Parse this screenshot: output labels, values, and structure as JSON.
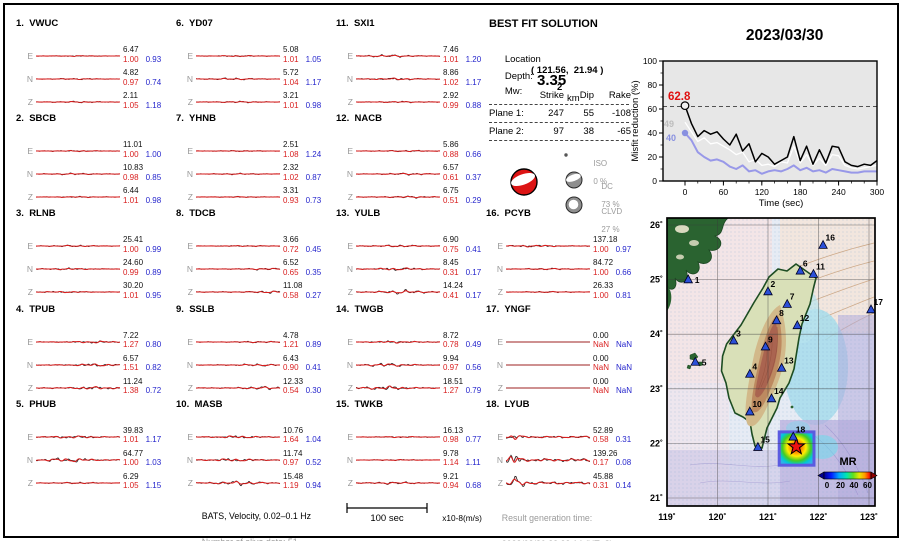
{
  "header": {
    "date": "2023/03/30",
    "time": "15:20:20  (UT)"
  },
  "solution": {
    "title": "BEST FIT SOLUTION",
    "location_label": "Location",
    "location_value": "( 121.56,  21.94 )",
    "depth_label": "Depth:",
    "depth_value": "2",
    "depth_unit": "km",
    "mw_label": "Mw:",
    "mw_value": "3.35",
    "table": {
      "headers": [
        "Strike",
        "Dip",
        "Rake"
      ],
      "rows": [
        {
          "label": "Plane 1:",
          "strike": "247",
          "dip": "55",
          "rake": "-108"
        },
        {
          "label": "Plane 2:",
          "strike": "97",
          "dip": "38",
          "rake": "-65"
        }
      ]
    },
    "decomposition": [
      {
        "name": "ISO",
        "percent": "0 %"
      },
      {
        "name": "DC",
        "percent": "73 %"
      },
      {
        "name": "CLVD",
        "percent": "27 %"
      }
    ]
  },
  "misfit_plot": {
    "ylabel": "Misfit reduction (%)",
    "xlabel": "Time (sec)",
    "peak_label": "62.8",
    "start_labels": {
      "white": "49",
      "blue": "40"
    },
    "yticks": [
      0,
      20,
      40,
      60,
      80,
      100
    ],
    "xticks": [
      0,
      60,
      120,
      180,
      240,
      300
    ]
  },
  "chart_data": {
    "type": "line",
    "title": "Misfit reduction vs time",
    "xlabel": "Time (sec)",
    "ylabel": "Misfit reduction (%)",
    "xlim": [
      0,
      300
    ],
    "ylim": [
      0,
      100
    ],
    "threshold_dashed_y": 62,
    "x": [
      0,
      10,
      20,
      30,
      40,
      50,
      60,
      70,
      80,
      90,
      100,
      110,
      120,
      130,
      140,
      150,
      160,
      170,
      180,
      190,
      200,
      210,
      220,
      230,
      240,
      250,
      260,
      270,
      280,
      290,
      300
    ],
    "series": [
      {
        "name": "best solution (black)",
        "color": "#000000",
        "y": [
          62.8,
          48,
          37,
          42,
          39,
          41,
          35,
          30,
          39,
          25,
          31,
          16,
          23,
          20,
          14,
          17,
          20,
          37,
          17,
          29,
          14,
          26,
          15,
          29,
          28,
          16,
          13,
          12,
          14,
          13,
          17
        ]
      },
      {
        "name": "reference solution (white)",
        "color": "#ffffff",
        "y": [
          49,
          41,
          33,
          36,
          31,
          32,
          29,
          26,
          22,
          24,
          16,
          18,
          13,
          14,
          12,
          16,
          15,
          29,
          15,
          22,
          13,
          19,
          13,
          22,
          21,
          13,
          11,
          10,
          11,
          12,
          13
        ]
      },
      {
        "name": "reference solution (blue)",
        "color": "#9898e8",
        "y": [
          40,
          34,
          24,
          20,
          17,
          18,
          16,
          12,
          10,
          13,
          8,
          9,
          6,
          8,
          9,
          8,
          10,
          13,
          9,
          11,
          8,
          9,
          7,
          10,
          9,
          8,
          7,
          7,
          8,
          8,
          8
        ]
      }
    ]
  },
  "stations": [
    {
      "num": "1",
      "name": "VWUC",
      "traces": [
        {
          "comp": "E",
          "amp": "6.47",
          "m1": "1.00",
          "m2": "0.93",
          "w": 0.7,
          "p": 0.5
        },
        {
          "comp": "N",
          "amp": "4.82",
          "m1": "0.97",
          "m2": "0.74",
          "w": 0.8,
          "p": 0.5
        },
        {
          "comp": "Z",
          "amp": "2.11",
          "m1": "1.05",
          "m2": "1.18",
          "w": 0.9,
          "p": 0.5
        }
      ]
    },
    {
      "num": "2",
      "name": "SBCB",
      "traces": [
        {
          "comp": "E",
          "amp": "11.01",
          "m1": "1.00",
          "m2": "1.00",
          "w": 0.9,
          "p": 0.5
        },
        {
          "comp": "N",
          "amp": "10.83",
          "m1": "0.98",
          "m2": "0.85",
          "w": 1.0,
          "p": 0.45
        },
        {
          "comp": "Z",
          "amp": "6.44",
          "m1": "1.01",
          "m2": "0.98",
          "w": 0.8,
          "p": 0.5
        }
      ]
    },
    {
      "num": "3",
      "name": "RLNB",
      "traces": [
        {
          "comp": "E",
          "amp": "25.41",
          "m1": "1.00",
          "m2": "0.99",
          "w": 1.1,
          "p": 0.45
        },
        {
          "comp": "N",
          "amp": "24.60",
          "m1": "0.99",
          "m2": "0.89",
          "w": 1.3,
          "p": 0.4
        },
        {
          "comp": "Z",
          "amp": "30.20",
          "m1": "1.01",
          "m2": "0.95",
          "w": 1.2,
          "p": 0.35
        }
      ]
    },
    {
      "num": "4",
      "name": "TPUB",
      "traces": [
        {
          "comp": "E",
          "amp": "7.22",
          "m1": "1.27",
          "m2": "0.80",
          "w": 1.8,
          "p": 0.68
        },
        {
          "comp": "N",
          "amp": "6.57",
          "m1": "1.51",
          "m2": "0.82",
          "w": 2.2,
          "p": 0.7
        },
        {
          "comp": "Z",
          "amp": "11.24",
          "m1": "1.38",
          "m2": "0.72",
          "w": 2.6,
          "p": 0.7
        }
      ]
    },
    {
      "num": "5",
      "name": "PHUB",
      "traces": [
        {
          "comp": "E",
          "amp": "39.83",
          "m1": "1.01",
          "m2": "1.17",
          "w": 2.4,
          "p": 0.45
        },
        {
          "comp": "N",
          "amp": "64.77",
          "m1": "1.00",
          "m2": "1.03",
          "w": 3.4,
          "p": 0.4
        },
        {
          "comp": "Z",
          "amp": "6.29",
          "m1": "1.05",
          "m2": "1.15",
          "w": 1.0,
          "p": 0.5
        }
      ]
    },
    {
      "num": "6",
      "name": "YD07",
      "traces": [
        {
          "comp": "E",
          "amp": "5.08",
          "m1": "1.01",
          "m2": "1.05",
          "w": 0.9,
          "p": 0.5
        },
        {
          "comp": "N",
          "amp": "5.72",
          "m1": "1.04",
          "m2": "1.17",
          "w": 1.2,
          "p": 0.45
        },
        {
          "comp": "Z",
          "amp": "3.21",
          "m1": "1.01",
          "m2": "0.98",
          "w": 0.9,
          "p": 0.5
        }
      ]
    },
    {
      "num": "7",
      "name": "YHNB",
      "traces": [
        {
          "comp": "E",
          "amp": "2.51",
          "m1": "1.08",
          "m2": "1.24",
          "w": 0.6,
          "p": 0.5
        },
        {
          "comp": "N",
          "amp": "2.32",
          "m1": "1.02",
          "m2": "0.87",
          "w": 0.8,
          "p": 0.5
        },
        {
          "comp": "Z",
          "amp": "3.31",
          "m1": "0.93",
          "m2": "0.73",
          "w": 0.7,
          "p": 0.5
        }
      ]
    },
    {
      "num": "8",
      "name": "TDCB",
      "traces": [
        {
          "comp": "E",
          "amp": "3.66",
          "m1": "0.72",
          "m2": "0.45",
          "w": 0.8,
          "p": 0.6
        },
        {
          "comp": "N",
          "amp": "6.52",
          "m1": "0.65",
          "m2": "0.35",
          "w": 1.2,
          "p": 0.85
        },
        {
          "comp": "Z",
          "amp": "11.08",
          "m1": "0.58",
          "m2": "0.27",
          "w": 1.6,
          "p": 0.9
        }
      ]
    },
    {
      "num": "9",
      "name": "SSLB",
      "traces": [
        {
          "comp": "E",
          "amp": "4.78",
          "m1": "1.21",
          "m2": "0.89",
          "w": 1.0,
          "p": 0.75
        },
        {
          "comp": "N",
          "amp": "6.43",
          "m1": "0.90",
          "m2": "0.41",
          "w": 1.4,
          "p": 0.75
        },
        {
          "comp": "Z",
          "amp": "12.33",
          "m1": "0.54",
          "m2": "0.30",
          "w": 2.0,
          "p": 0.8
        }
      ]
    },
    {
      "num": "10",
      "name": "MASB",
      "traces": [
        {
          "comp": "E",
          "amp": "10.76",
          "m1": "1.64",
          "m2": "1.04",
          "w": 2.2,
          "p": 0.5
        },
        {
          "comp": "N",
          "amp": "11.74",
          "m1": "0.97",
          "m2": "0.52",
          "w": 2.6,
          "p": 0.45
        },
        {
          "comp": "Z",
          "amp": "15.48",
          "m1": "1.19",
          "m2": "0.94",
          "w": 2.8,
          "p": 0.5
        }
      ]
    },
    {
      "num": "11",
      "name": "SXI1",
      "traces": [
        {
          "comp": "E",
          "amp": "7.46",
          "m1": "1.01",
          "m2": "1.20",
          "w": 1.5,
          "p": 0.4
        },
        {
          "comp": "N",
          "amp": "8.86",
          "m1": "1.02",
          "m2": "1.17",
          "w": 1.7,
          "p": 0.45
        },
        {
          "comp": "Z",
          "amp": "2.92",
          "m1": "0.99",
          "m2": "0.88",
          "w": 0.9,
          "p": 0.5
        }
      ]
    },
    {
      "num": "12",
      "name": "NACB",
      "traces": [
        {
          "comp": "E",
          "amp": "5.86",
          "m1": "0.88",
          "m2": "0.66",
          "w": 1.0,
          "p": 0.6
        },
        {
          "comp": "N",
          "amp": "6.57",
          "m1": "0.61",
          "m2": "0.37",
          "w": 1.2,
          "p": 0.6
        },
        {
          "comp": "Z",
          "amp": "6.75",
          "m1": "0.51",
          "m2": "0.29",
          "w": 1.3,
          "p": 0.65
        }
      ]
    },
    {
      "num": "13",
      "name": "YULB",
      "traces": [
        {
          "comp": "E",
          "amp": "6.90",
          "m1": "0.75",
          "m2": "0.41",
          "w": 1.3,
          "p": 0.5
        },
        {
          "comp": "N",
          "amp": "8.45",
          "m1": "0.31",
          "m2": "0.17",
          "w": 2.2,
          "p": 0.5
        },
        {
          "comp": "Z",
          "amp": "14.24",
          "m1": "0.41",
          "m2": "0.17",
          "w": 2.4,
          "p": 0.55
        }
      ]
    },
    {
      "num": "14",
      "name": "TWGB",
      "traces": [
        {
          "comp": "E",
          "amp": "8.72",
          "m1": "0.78",
          "m2": "0.49",
          "w": 1.8,
          "p": 0.45
        },
        {
          "comp": "N",
          "amp": "9.94",
          "m1": "0.97",
          "m2": "0.56",
          "w": 2.4,
          "p": 0.4
        },
        {
          "comp": "Z",
          "amp": "18.51",
          "m1": "1.27",
          "m2": "0.79",
          "w": 3.2,
          "p": 0.38
        }
      ]
    },
    {
      "num": "15",
      "name": "TWKB",
      "traces": [
        {
          "comp": "E",
          "amp": "16.13",
          "m1": "0.98",
          "m2": "0.77",
          "w": 1.0,
          "p": 0.55
        },
        {
          "comp": "N",
          "amp": "9.78",
          "m1": "1.14",
          "m2": "1.11",
          "w": 0.8,
          "p": 0.5
        },
        {
          "comp": "Z",
          "amp": "9.21",
          "m1": "0.94",
          "m2": "0.68",
          "w": 1.6,
          "p": 0.45
        }
      ]
    },
    {
      "num": "16",
      "name": "PCYB",
      "traces": [
        {
          "comp": "E",
          "amp": "137.18",
          "m1": "1.00",
          "m2": "0.97",
          "w": 1.8,
          "p": 0.35
        },
        {
          "comp": "N",
          "amp": "84.72",
          "m1": "1.00",
          "m2": "0.66",
          "w": 1.0,
          "p": 0.5
        },
        {
          "comp": "Z",
          "amp": "26.33",
          "m1": "1.00",
          "m2": "0.81",
          "w": 0.8,
          "p": 0.5
        }
      ]
    },
    {
      "num": "17",
      "name": "YNGF",
      "traces": [
        {
          "comp": "E",
          "amp": "0.00",
          "m1": "NaN",
          "m2": "NaN",
          "w": 0,
          "p": 0.5
        },
        {
          "comp": "N",
          "amp": "0.00",
          "m1": "NaN",
          "m2": "NaN",
          "w": 0,
          "p": 0.5
        },
        {
          "comp": "Z",
          "amp": "0.00",
          "m1": "NaN",
          "m2": "NaN",
          "w": 0,
          "p": 0.5
        }
      ]
    },
    {
      "num": "18",
      "name": "LYUB",
      "traces": [
        {
          "comp": "E",
          "amp": "52.89",
          "m1": "0.58",
          "m2": "0.31",
          "w": 6,
          "p": 0.1
        },
        {
          "comp": "N",
          "amp": "139.26",
          "m1": "0.17",
          "m2": "0.08",
          "w": 10,
          "p": 0.1
        },
        {
          "comp": "Z",
          "amp": "45.88",
          "m1": "0.31",
          "m2": "0.14",
          "w": 8,
          "p": 0.13
        }
      ]
    }
  ],
  "footer": {
    "line1": "BATS, Velocity, 0.02–0.1 Hz",
    "line2": "Number of alive data: 51",
    "scalebar_label": "100 sec",
    "units_label": "x10-8(m/s)",
    "misfit1_label": "misfit1",
    "misfit2_label": "misfit2",
    "result_time_label": "Result generation time:",
    "result_time_value": "2023/03/30 23:22:14 (UT+8)"
  },
  "map": {
    "lat_ticks": [
      {
        "label": "26˚",
        "v": 26
      },
      {
        "label": "25˚",
        "v": 25
      },
      {
        "label": "24˚",
        "v": 24
      },
      {
        "label": "23˚",
        "v": 23
      },
      {
        "label": "22˚",
        "v": 22
      },
      {
        "label": "21˚",
        "v": 21
      }
    ],
    "lon_ticks": [
      {
        "label": "119˚",
        "v": 119
      },
      {
        "label": "120˚",
        "v": 120
      },
      {
        "label": "121˚",
        "v": 121
      },
      {
        "label": "122˚",
        "v": 122
      },
      {
        "label": "123˚",
        "v": 123
      }
    ],
    "mr_label": "MR",
    "mr_tick_labels": [
      "0",
      "20",
      "40",
      "60"
    ],
    "stations": [
      {
        "n": "1",
        "lon": 119.42,
        "lat": 25.0,
        "side": "right"
      },
      {
        "n": "2",
        "lon": 121.0,
        "lat": 24.78
      },
      {
        "n": "3",
        "lon": 120.32,
        "lat": 23.88
      },
      {
        "n": "4",
        "lon": 120.64,
        "lat": 23.27
      },
      {
        "n": "5",
        "lon": 119.56,
        "lat": 23.49,
        "side": "right"
      },
      {
        "n": "6",
        "lon": 121.64,
        "lat": 25.16
      },
      {
        "n": "7",
        "lon": 121.38,
        "lat": 24.55
      },
      {
        "n": "8",
        "lon": 121.17,
        "lat": 24.25
      },
      {
        "n": "9",
        "lon": 120.95,
        "lat": 23.77
      },
      {
        "n": "10",
        "lon": 120.64,
        "lat": 22.58
      },
      {
        "n": "11",
        "lon": 121.9,
        "lat": 25.1
      },
      {
        "n": "12",
        "lon": 121.58,
        "lat": 24.16
      },
      {
        "n": "13",
        "lon": 121.27,
        "lat": 23.38
      },
      {
        "n": "14",
        "lon": 121.07,
        "lat": 22.82
      },
      {
        "n": "15",
        "lon": 120.8,
        "lat": 21.93
      },
      {
        "n": "16",
        "lon": 122.09,
        "lat": 25.63
      },
      {
        "n": "17",
        "lon": 123.04,
        "lat": 24.45
      },
      {
        "n": "18",
        "lon": 121.5,
        "lat": 22.12
      }
    ],
    "epicenter": {
      "lon": 121.56,
      "lat": 21.94
    }
  }
}
